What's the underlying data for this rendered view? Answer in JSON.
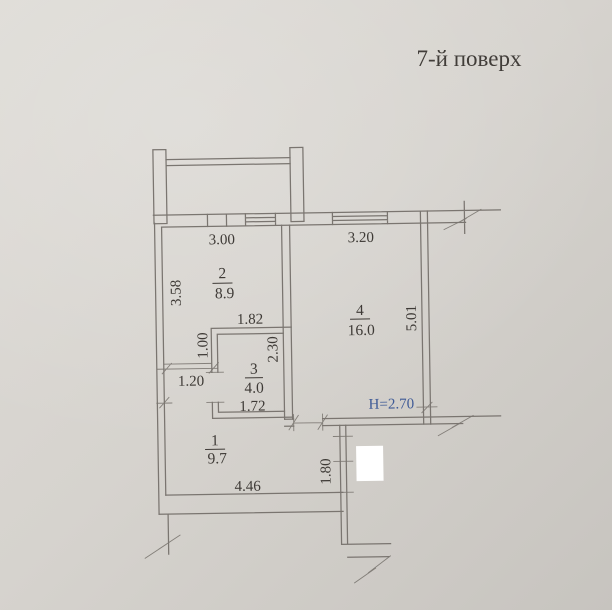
{
  "page": {
    "title": "7-й поверх"
  },
  "colors": {
    "paper": "#d6d3ce",
    "paper_light": "#dedbd6",
    "paper_dark": "#c7c4bf",
    "line": "#7a7570",
    "ink": "#3e3a36",
    "blue": "#3e5a96",
    "white": "#ffffff"
  },
  "rooms": {
    "room1": {
      "number": "1",
      "area": "9.7"
    },
    "room2": {
      "number": "2",
      "area": "8.9"
    },
    "room3": {
      "number": "3",
      "area": "4.0"
    },
    "room4": {
      "number": "4",
      "area": "16.0"
    }
  },
  "dimensions": {
    "room2_width": "3.00",
    "room2_depth": "3.58",
    "room4_width": "3.20",
    "room4_depth": "5.01",
    "room3_top": "1.82",
    "room3_bottom": "1.72",
    "room3_depth": "2.30",
    "niche_depth": "1.00",
    "passage_width": "1.20",
    "hall_width": "4.46",
    "entry_depth": "1.80"
  },
  "annotations": {
    "ceiling_height": "H=2.70"
  }
}
